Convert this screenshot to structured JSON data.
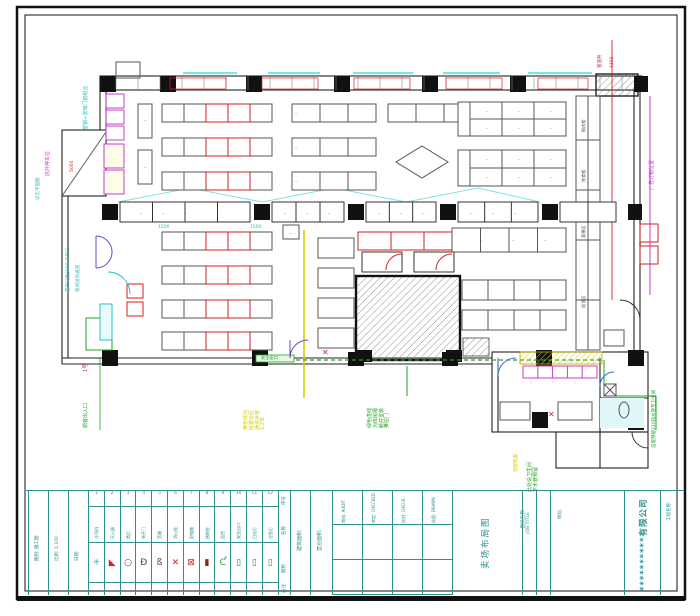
{
  "sheet": {
    "company": "**********有限公司",
    "project_label": "工程名称:",
    "address_label": "地址:",
    "job_title_label": "图纸名称:",
    "job_title_en": "JOB TITLE",
    "drawing_name": "卖场布局图",
    "fields": [
      {
        "cn": "审核",
        "en": "AUDIT"
      },
      {
        "cn": "审定",
        "en": "CHECKED"
      },
      {
        "cn": "校对",
        "en": "CHECK"
      },
      {
        "cn": "绘图",
        "en": "DRAWN"
      }
    ],
    "left_fields": [
      {
        "label": "图别",
        "value": "施工图"
      },
      {
        "label": "比例",
        "value": "1:100"
      },
      {
        "label": "日期",
        "value": ""
      }
    ],
    "area_labels": [
      "建筑面积:",
      "营业面积:"
    ]
  },
  "legend": {
    "row_labels": [
      "序号",
      "名称",
      "图例",
      "备注"
    ],
    "numbers": [
      "1",
      "2",
      "3",
      "4",
      "5",
      "6",
      "7",
      "8",
      "9",
      "10",
      "11",
      "12"
    ],
    "items": [
      {
        "name": "冷风机",
        "glyph": "✳",
        "color": "#2fbfbf"
      },
      {
        "name": "灭火器",
        "glyph": "◣",
        "color": "#d22222"
      },
      {
        "name": "筒灯",
        "glyph": "○",
        "color": "#444444"
      },
      {
        "name": "单开门",
        "glyph": "Ð",
        "color": "#444444"
      },
      {
        "name": "音箱",
        "glyph": "ß",
        "color": "#444444"
      },
      {
        "name": "消火栓",
        "glyph": "✕",
        "color": "#d22222"
      },
      {
        "name": "配电箱",
        "glyph": "⊠",
        "color": "#d22222"
      },
      {
        "name": "结构柱",
        "glyph": "▮",
        "color": "#8b2020"
      },
      {
        "name": "监控",
        "glyph": "Ƈ",
        "color": "#1fa321"
      },
      {
        "name": "安全出口",
        "glyph": "▯",
        "color": "#1fa321"
      },
      {
        "name": "日光灯",
        "glyph": "▯",
        "color": "#1fa321"
      },
      {
        "name": "应急灯",
        "glyph": "▯",
        "color": "#1fa321"
      }
    ]
  },
  "plan": {
    "micro_char": "··",
    "annotations": [
      {
        "text": "塑钢+玻璃门窗组合",
        "color": "#2fbfbf",
        "x": 84,
        "y": 130,
        "rot": 1,
        "size": 5
      },
      {
        "text": "店外停车位",
        "color": "#c83cc8",
        "x": 46,
        "y": 176,
        "rot": 1,
        "size": 5
      },
      {
        "text": "详见平面图",
        "color": "#2fbfbf",
        "x": 36,
        "y": 200,
        "rot": 1,
        "size": 4.5
      },
      {
        "text": "5000",
        "color": "#d22222",
        "x": 70,
        "y": 172,
        "rot": 1,
        "size": 4.5
      },
      {
        "text": "卷帘门宽3000 下货口",
        "color": "#2fbfbf",
        "x": 66,
        "y": 292,
        "rot": 1,
        "size": 4.5
      },
      {
        "text": "夜间进货通道",
        "color": "#2fbfbf",
        "x": 76,
        "y": 292,
        "rot": 1,
        "size": 4.5
      },
      {
        "text": "1号",
        "color": "#d22222",
        "x": 84,
        "y": 372,
        "rot": 1,
        "size": 5
      },
      {
        "text": "顾客出入口",
        "color": "#1fa321",
        "x": 84,
        "y": 428,
        "rot": 1,
        "size": 5
      },
      {
        "text": "黄色线为\n收银台区\n通道净宽\n1.2米",
        "color": "#d9cb00",
        "x": 244,
        "y": 430,
        "rot": 1,
        "size": 5
      },
      {
        "text": "绿色虚线\n为库房隔\n断并安装\n推拉门",
        "color": "#1fa321",
        "x": 368,
        "y": 428,
        "rot": 1,
        "size": 5
      },
      {
        "text": "此处设卫生间\n下水管预留",
        "color": "#1fa321",
        "x": 528,
        "y": 492,
        "rot": 1,
        "size": 5
      },
      {
        "text": "预留地漏",
        "color": "#d9cb00",
        "x": 514,
        "y": 472,
        "rot": 1,
        "size": 4.5
      },
      {
        "text": "沿墙预留210排水管至卫生间",
        "color": "#1fa321",
        "x": 652,
        "y": 448,
        "rot": 1,
        "size": 4.5
      },
      {
        "text": "广告灯箱位置",
        "color": "#c83cc8",
        "x": 650,
        "y": 190,
        "rot": 1,
        "size": 5
      },
      {
        "text": "管道井",
        "color": "#d22222",
        "x": 598,
        "y": 68,
        "rot": 1,
        "size": 4.5
      },
      {
        "text": "4300",
        "color": "#d22222",
        "x": 610,
        "y": 68,
        "rot": 1,
        "size": 4.5
      },
      {
        "text": "1500",
        "color": "#2fbfbf",
        "x": 158,
        "y": 225,
        "rot": 0,
        "size": 4.5
      },
      {
        "text": "1500",
        "color": "#2fbfbf",
        "x": 250,
        "y": 225,
        "rot": 0,
        "size": 4.5
      },
      {
        "text": "安全出口",
        "color": "#1fa321",
        "x": 261,
        "y": 356,
        "rot": 0,
        "size": 4.2
      },
      {
        "text": "鲜肉柜",
        "color": "#555555",
        "x": 582,
        "y": 132,
        "rot": 1,
        "size": 4.2
      },
      {
        "text": "熟食柜",
        "color": "#555555",
        "x": 582,
        "y": 182,
        "rot": 1,
        "size": 4.2
      },
      {
        "text": "蔬果区",
        "color": "#555555",
        "x": 582,
        "y": 238,
        "rot": 1,
        "size": 4.2
      },
      {
        "text": "收货区",
        "color": "#555555",
        "x": 582,
        "y": 308,
        "rot": 1,
        "size": 4.2
      },
      {
        "text": "✕",
        "color": "#d22222",
        "x": 548,
        "y": 410,
        "rot": 0,
        "size": 8
      },
      {
        "text": "✕",
        "color": "#d22222",
        "x": 322,
        "y": 348,
        "rot": 0,
        "size": 8
      }
    ],
    "micro_marks": [
      [
        144,
        118,
        "d"
      ],
      [
        144,
        165,
        "d"
      ],
      [
        295,
        111,
        "d"
      ],
      [
        295,
        145,
        "d"
      ],
      [
        295,
        179,
        "d"
      ],
      [
        289,
        231,
        "d"
      ],
      [
        140,
        211,
        "d"
      ],
      [
        162,
        211,
        "d"
      ],
      [
        184,
        211,
        "d"
      ],
      [
        284,
        211,
        "d"
      ],
      [
        306,
        211,
        "d"
      ],
      [
        328,
        211,
        "d"
      ],
      [
        378,
        211,
        "d"
      ],
      [
        400,
        211,
        "d"
      ],
      [
        422,
        211,
        "d"
      ],
      [
        470,
        211,
        "d"
      ],
      [
        492,
        211,
        "d"
      ],
      [
        514,
        211,
        "d"
      ],
      [
        486,
        109,
        "r"
      ],
      [
        518,
        109,
        "r"
      ],
      [
        550,
        109,
        "r"
      ],
      [
        486,
        126,
        "r"
      ],
      [
        518,
        126,
        "r"
      ],
      [
        550,
        126,
        "r"
      ],
      [
        486,
        157,
        "r"
      ],
      [
        518,
        157,
        "r"
      ],
      [
        550,
        157,
        "r"
      ],
      [
        486,
        175,
        "r"
      ],
      [
        518,
        175,
        "r"
      ],
      [
        550,
        175,
        "r"
      ],
      [
        480,
        238,
        "r"
      ],
      [
        512,
        238,
        "r"
      ],
      [
        544,
        238,
        "r"
      ],
      [
        530,
        380,
        "m"
      ],
      [
        552,
        380,
        "m"
      ],
      [
        574,
        380,
        "m"
      ]
    ]
  },
  "colors": {
    "red": "#d22222",
    "dark": "#555555",
    "magenta": "#c83cc8",
    "teal": "#2e8f8f"
  }
}
